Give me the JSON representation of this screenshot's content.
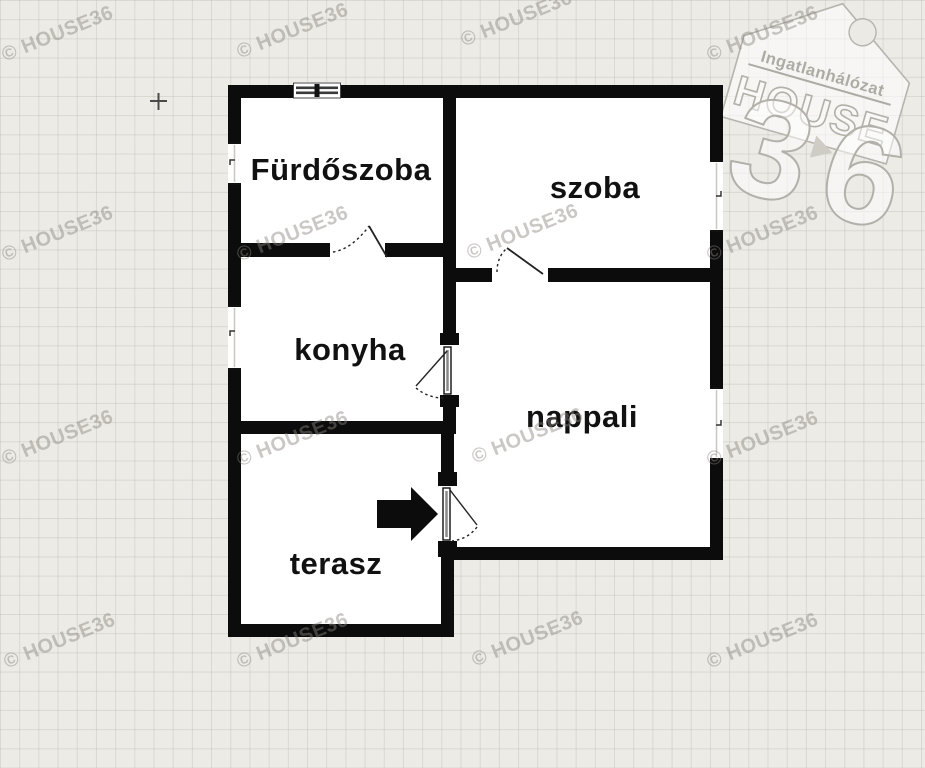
{
  "watermark": {
    "text": "© HOUSE36"
  },
  "logo": {
    "network_label": "Ingatlanhálózat",
    "brand_word": "HOUSE",
    "brand_digit_3": "3",
    "brand_digit_6": "6"
  },
  "rooms": [
    {
      "id": "furdoszoba",
      "label": "Fürdőszoba"
    },
    {
      "id": "szoba",
      "label": "szoba"
    },
    {
      "id": "konyha",
      "label": "konyha"
    },
    {
      "id": "nappali",
      "label": "nappali"
    },
    {
      "id": "terasz",
      "label": "terasz"
    }
  ],
  "plan": {
    "wall_color": "#0c0c0c",
    "floor_color": "#ffffff",
    "entrance_arrow_direction": "right"
  }
}
